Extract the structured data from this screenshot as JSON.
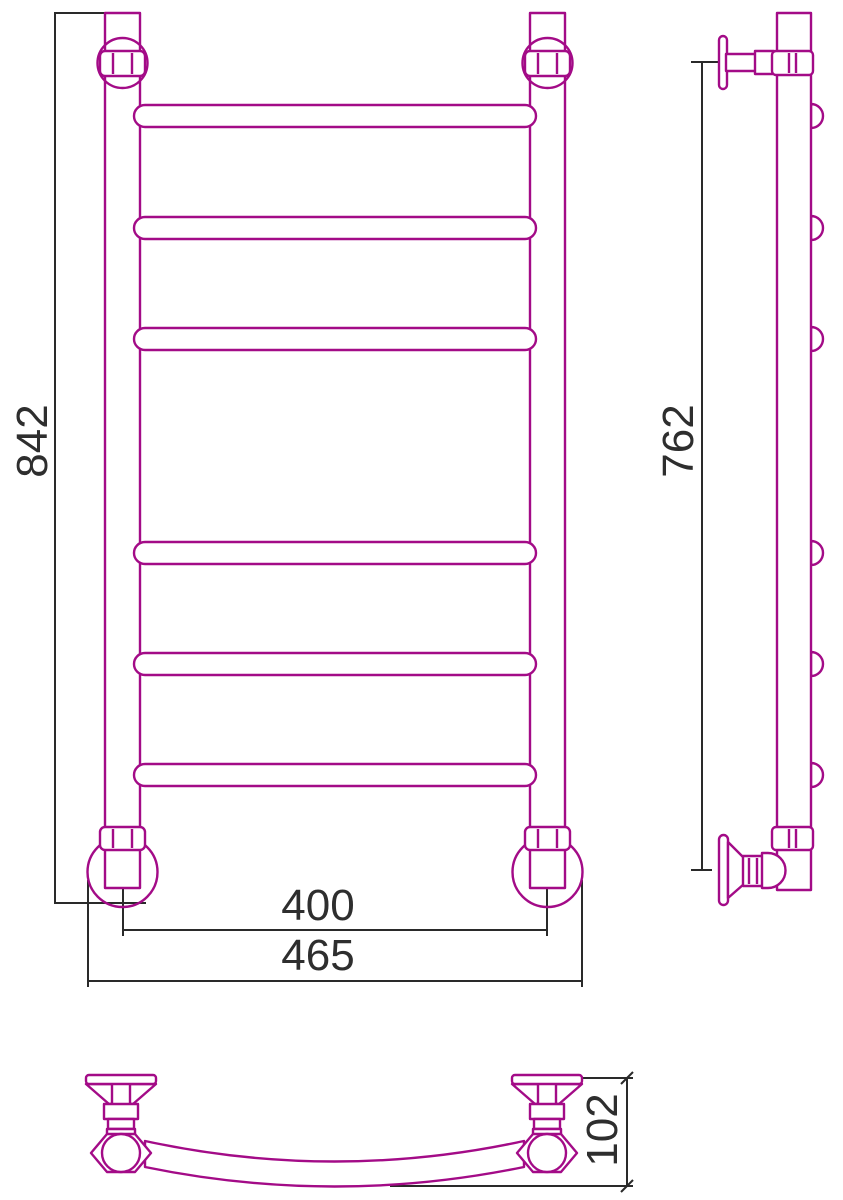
{
  "drawing": {
    "background": "#ffffff",
    "outline_color": "#A30B87",
    "dimension_line_color": "#2a2a2a",
    "dimension_text_color": "#2e2e2e",
    "dimensions": {
      "overall_height": "842",
      "mount_height": "762",
      "inner_width": "400",
      "outer_width": "465",
      "depth": "102"
    }
  }
}
